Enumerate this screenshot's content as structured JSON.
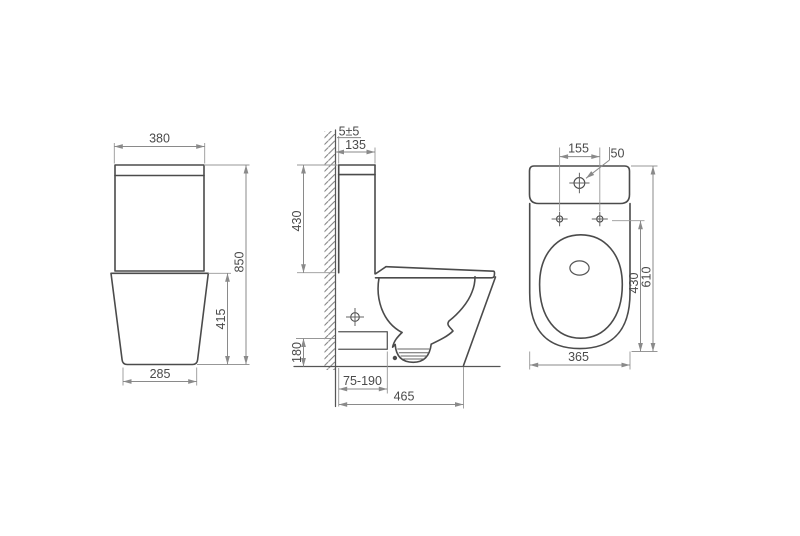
{
  "drawing": {
    "background": "#ffffff",
    "object_line_color": "#4b4b4b",
    "dimension_line_color": "#8a8a8a",
    "text_color": "#4a4a4a",
    "views": {
      "front": {
        "dims": {
          "tank_width": "380",
          "overall_height": "850",
          "base_height": "415",
          "base_width": "285"
        }
      },
      "side": {
        "dims": {
          "wall_gap": "5±5",
          "tank_depth": "135",
          "upper_height": "430",
          "outlet_height": "180",
          "outlet_setout_range": "75-190",
          "overall_depth": "465"
        }
      },
      "top": {
        "dims": {
          "fixing_hole_spacing": "155",
          "inlet_hole": "50",
          "seat_length": "430",
          "overall_length": "610",
          "overall_width": "365"
        }
      }
    }
  }
}
